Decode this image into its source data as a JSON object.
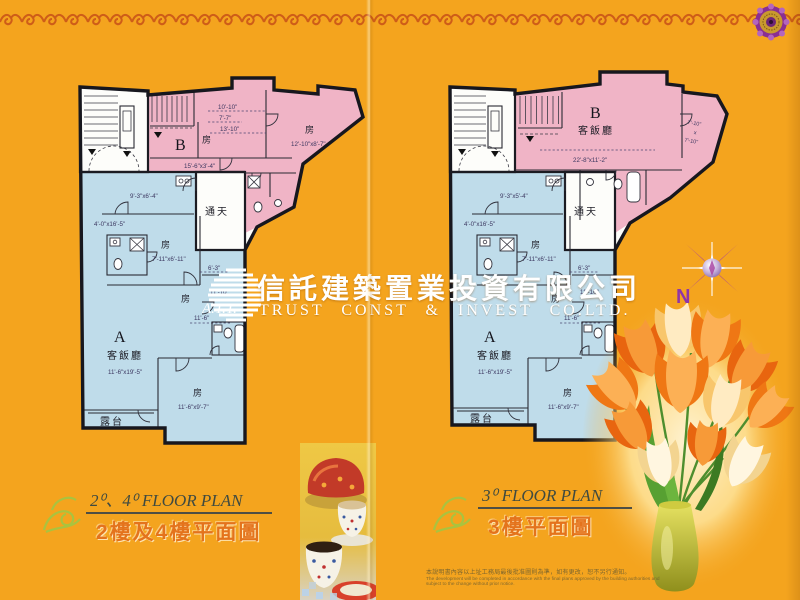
{
  "palette": {
    "background": "#F4A41E",
    "border_wave": "#CE5D18",
    "unit_b_pink": "#F0B4C6",
    "unit_a_blue": "#BFDCEA",
    "caption_orange": "#E4731C",
    "compass_purple": "#A63FA0",
    "text_white": "#FFFFFF"
  },
  "icons": {
    "medallion": "rosette-ornament-icon",
    "swirl": "floral-flourish-icon",
    "compass": "compass-star-icon",
    "logo": "striped-globe-logo",
    "flowers": "tulip-bouquet-image",
    "tea": "tea-set-photo"
  },
  "company": {
    "logo_text": "A.T.T.",
    "name_zh": "信託建築置業投資有限公司",
    "name_en": "TRUST CONST & INVEST CO.LTD."
  },
  "compass": {
    "north_label": "N"
  },
  "plans": {
    "left": {
      "caption_en": "2⁰、4⁰ FLOOR PLAN",
      "caption_zh": "2樓及4樓平面圖",
      "labels": {
        "b": "B",
        "b_room": "房",
        "d1": "10'-10\"",
        "d2": "7'-7\"",
        "d3": "13'-10\"",
        "b_room2": "房",
        "b_room2_dim": "12'-10\"x8'-7\"",
        "corridor_dim": "15'-6\"x3'-4\"",
        "kitchen_dim": "9'-3\"x6'-4\"",
        "hall_dim": "4'-0\"x16'-5\"",
        "mid_room": "房",
        "mid_room_dim": "7'-11\"x6'-11\"",
        "skywell": "通天",
        "d63": "6'-3\"",
        "d1110": "11'-10\"",
        "right_room": "房",
        "d116": "11'-6\"",
        "a": "A",
        "living": "客飯廳",
        "living_dim": "11'-6\"x19'-5\"",
        "bot_room": "房",
        "bot_room_dim": "11'-6\"x9'-7\"",
        "balcony": "露台"
      }
    },
    "right": {
      "caption_en": "3⁰ FLOOR PLAN",
      "caption_zh": "3樓平面圖",
      "labels": {
        "b": "B",
        "b_living": "客飯廳",
        "b_living_dim": "22'-8\"x11'-2\"",
        "b_room_d1": "7'-10\"",
        "b_room_x": "x",
        "b_room_d2": "7'-10\"",
        "kitchen_dim": "9'-3\"x5'-4\"",
        "hall_dim": "4'-0\"x16'-5\"",
        "mid_room": "房",
        "mid_room_dim": "7'-11\"x6'-11\"",
        "skywell": "通天",
        "d63": "6'-3\"",
        "d1110": "11'-10\"",
        "right_room": "房",
        "d116": "11'-6\"",
        "a": "A",
        "living": "客飯廳",
        "living_dim": "11'-6\"x19'-5\"",
        "bot_room": "房",
        "bot_room_dim": "11'-6\"x9'-7\"",
        "balcony": "露台"
      }
    }
  },
  "footer": {
    "disclaimer_zh": "本說明書內容以上址工務局最後批准圖則為準，如有更改，恕不另行通知。",
    "disclaimer_en": "The development will be completed in accordance with the final plans approved by the building authorities and subject to the change without prior notice."
  }
}
